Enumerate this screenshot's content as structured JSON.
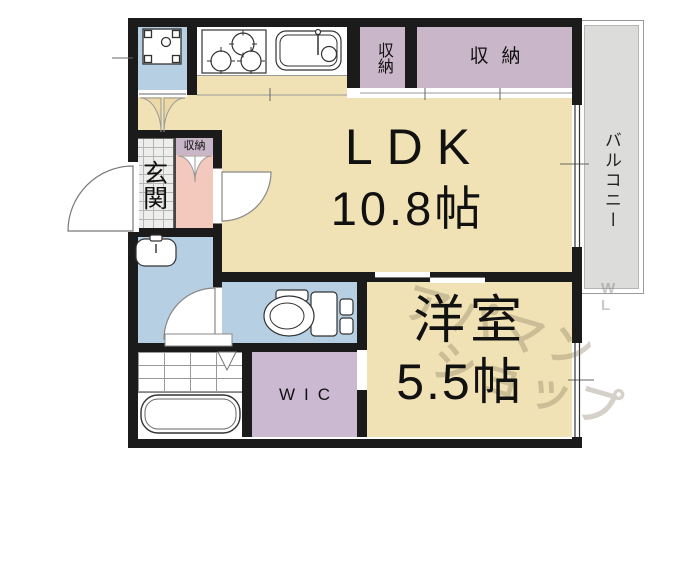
{
  "floorplan": {
    "ldk": {
      "label": "LDK",
      "area": "10.8帖"
    },
    "western_room": {
      "label": "洋室",
      "area": "5.5帖"
    },
    "wic": {
      "label": "WIC"
    },
    "entrance": {
      "label": "玄関"
    },
    "balcony": {
      "label": "バルコニー"
    },
    "storage_top_small": {
      "label": "収納"
    },
    "storage_top_wide": {
      "label": "収納"
    },
    "storage_hall": {
      "label": "収納"
    },
    "watermark": {
      "line1": "アパマン",
      "line2": "ショップ",
      "side": "W\nL"
    },
    "colors": {
      "floor_tan": "#f0e2b4",
      "storage_purple": "#c9b6c9",
      "wic_purple": "#cbb9d2",
      "wet_area_blue": "#b6cfe2",
      "hall_pink": "#f4c9bd",
      "balcony_gray": "#dcdcda",
      "wall_black": "#1b1b1b"
    }
  }
}
